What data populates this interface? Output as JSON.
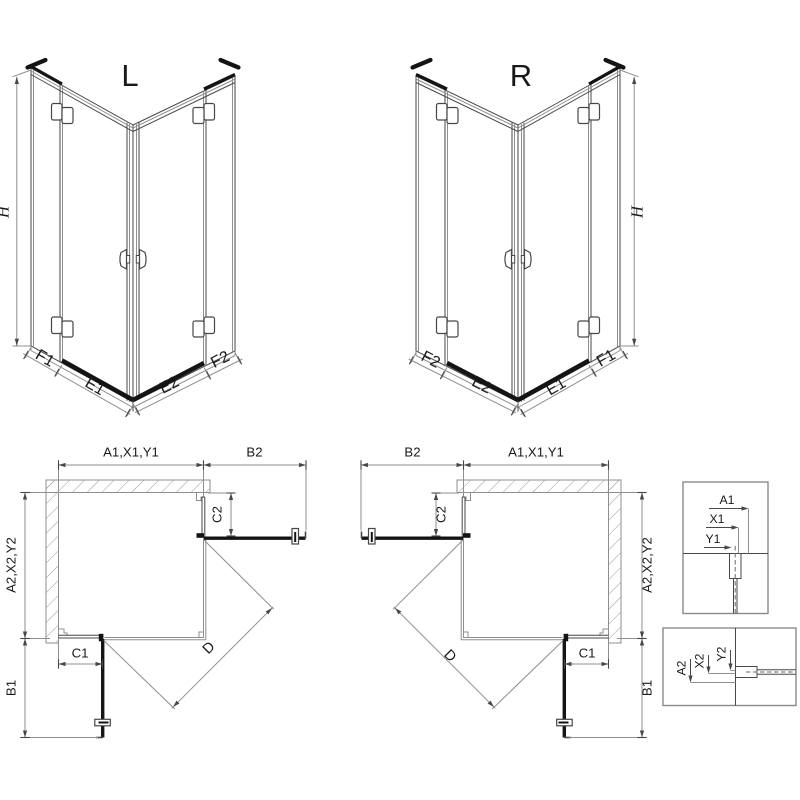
{
  "colors": {
    "line": "#474747",
    "light": "#8f8f8f",
    "dark": "#141414",
    "hatch": "#9a9a9a",
    "background": "#ffffff"
  },
  "views": {
    "iso_left": {
      "title": "L",
      "dims": {
        "h": "H",
        "f1": "F1",
        "e1": "E1",
        "e2": "E2",
        "f2": "F2"
      }
    },
    "iso_right": {
      "title": "R",
      "dims": {
        "h": "H",
        "f1": "F1",
        "e1": "E1",
        "e2": "E2",
        "f2": "F2"
      }
    },
    "plan_left": {
      "dims": {
        "top": "A1,X1,Y1",
        "top_right": "B2",
        "right_upper": "C2",
        "left": "A2,X2,Y2",
        "left_lower": "B1",
        "bottom": "C1",
        "diagonal": "D"
      }
    },
    "plan_right": {
      "dims": {
        "top_left": "B2",
        "top": "A1,X1,Y1",
        "left_upper": "C2",
        "right": "A2,X2,Y2",
        "right_lower": "B1",
        "bottom": "C1",
        "diagonal": "D"
      }
    },
    "detail_upper": {
      "dims": {
        "a1": "A1",
        "x1": "X1",
        "y1": "Y1"
      }
    },
    "detail_lower": {
      "dims": {
        "a2": "A2",
        "x2": "X2",
        "y2": "Y2"
      }
    }
  }
}
